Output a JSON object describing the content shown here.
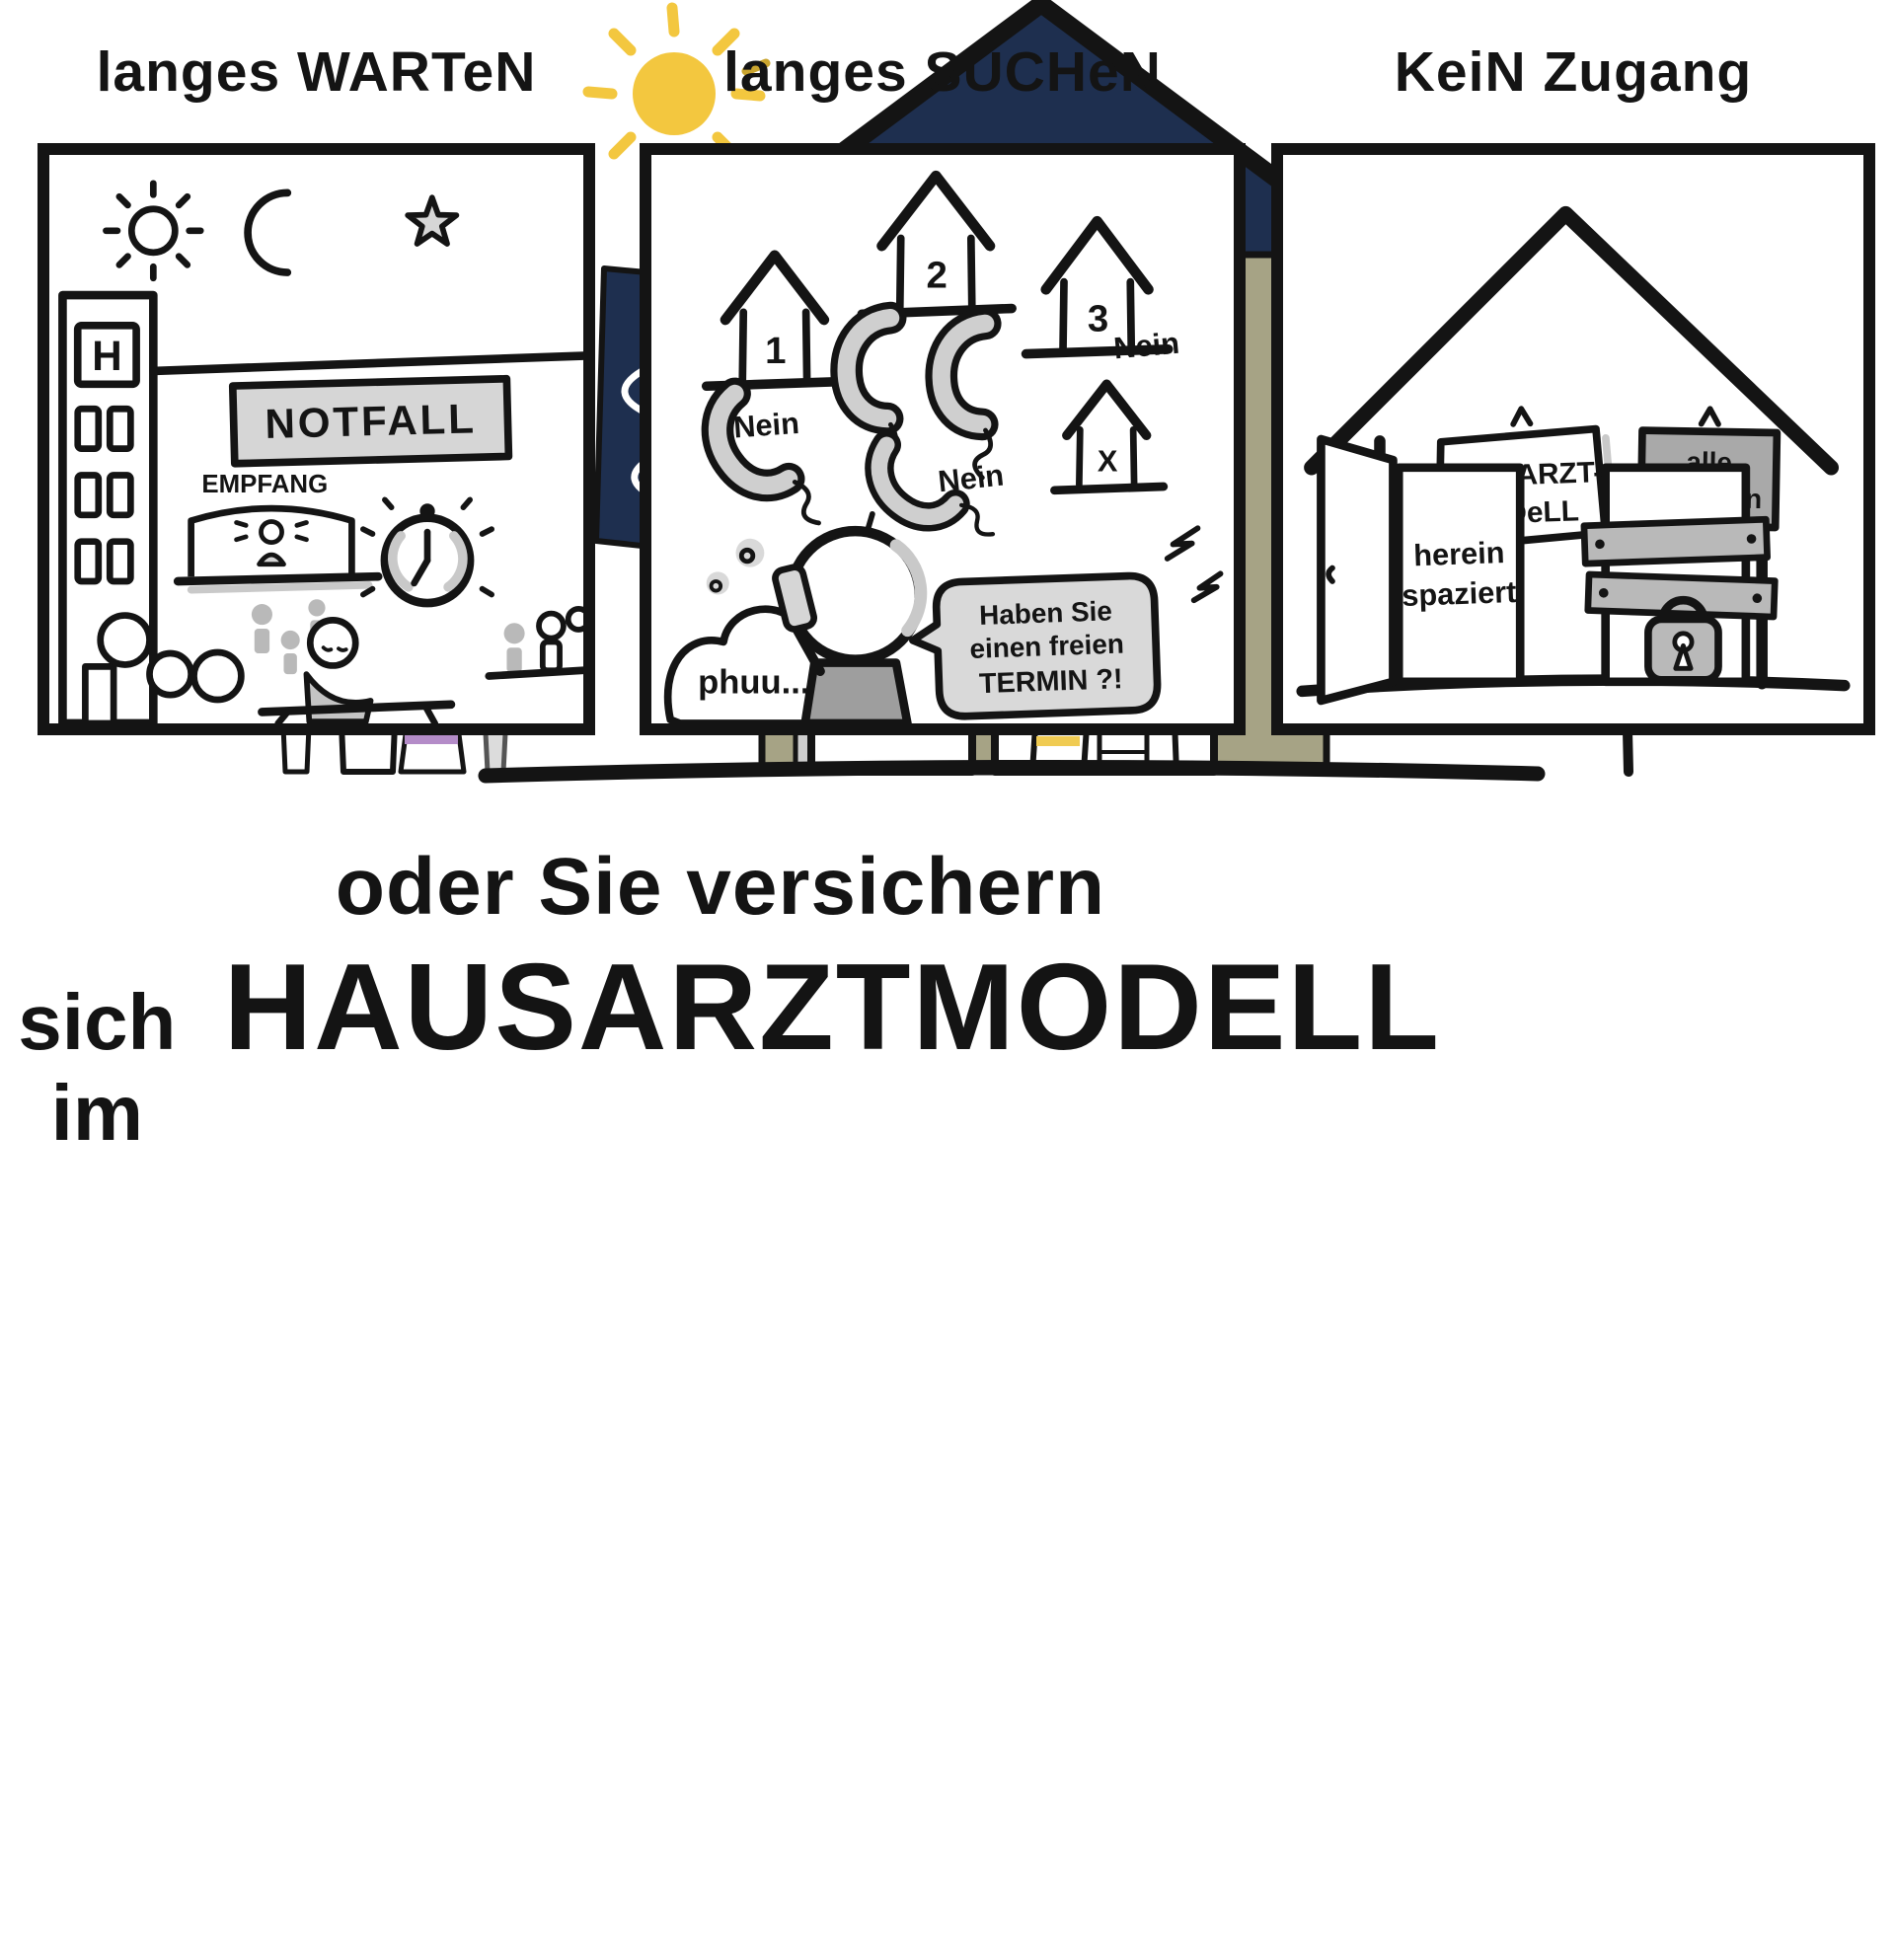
{
  "colors": {
    "ink": "#141414",
    "light_gray": "#d6d6d6",
    "mid_gray": "#9e9e9e",
    "nein_gray": "#c6c6c6",
    "navy": "#1e2f4f",
    "facade_olive": "#a6a385",
    "sun_yellow": "#f3c73f",
    "stripe_yellow": "#f0cb52",
    "stripe_blue": "#8ea0cf",
    "stripe_purple": "#b48cc8",
    "heart_red": "#cf3a2c",
    "tree_green": "#b9d2a3"
  },
  "panel1": {
    "title": "langes WARTeN",
    "h_sign": "H",
    "notfall": "NOTFALL",
    "empfang": "EMPFANG"
  },
  "panel2": {
    "title": "langes SUCHeN",
    "house1": "1",
    "house2": "2",
    "house3": "3",
    "house_x": "X",
    "nein1": "Nein",
    "nein2": "Nein",
    "nein3": "Nein",
    "thought": "phuu...",
    "speech1": "Haben Sie",
    "speech2": "einen freien",
    "speech3": "TERMIN ?!"
  },
  "panel3": {
    "title": "KeiN Zugang",
    "sign_left1": "HAuSARZT-",
    "sign_left2": "MoDeLL",
    "sign_right1": "alle",
    "sign_right2": "anderen",
    "door1": "herein",
    "door2": "spaziert"
  },
  "headline": {
    "line1": "oder Sie versichern",
    "line2_small": "sich im",
    "line2_big": "HAUSARZTMODELL"
  },
  "bottom": {
    "family_line1": "für die ganze",
    "family_line2": "FAMILIE",
    "welcome_line1": "Sie sind",
    "welcome_heart": "♥",
    "welcome_line2": "-Lich",
    "welcome_line3": "willkommen !",
    "hausarzt_sign": "HAuSARZT",
    "empfang_sign": "EMPFANG"
  }
}
